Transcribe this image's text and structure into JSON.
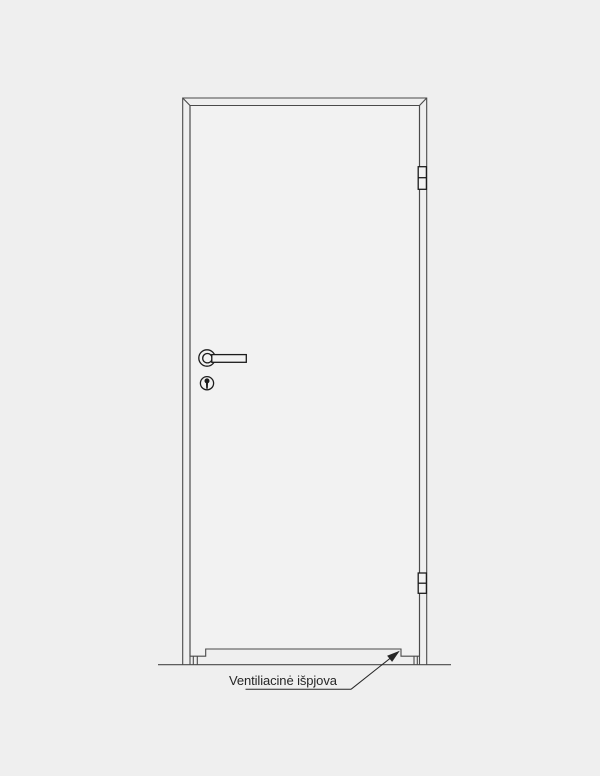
{
  "colors": {
    "background": "#efefef",
    "door_fill": "#f2f2f2",
    "line": "#4a4a4a",
    "detail": "#1c1c1c",
    "text": "#262626"
  },
  "annotation": {
    "label": "Ventiliacinė išpjova"
  }
}
